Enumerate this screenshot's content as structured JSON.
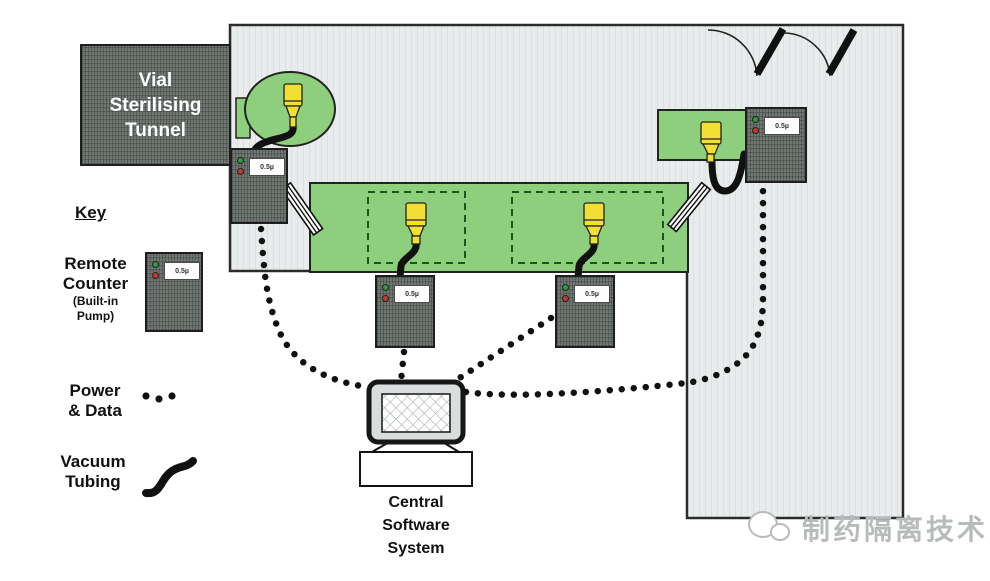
{
  "tunnel": {
    "label": "Vial\nSterilising\nTunnel"
  },
  "key": {
    "title": "Key",
    "remote_counter": {
      "label": "Remote\nCounter",
      "sublabel": "(Built-in\nPump)"
    },
    "power_data": {
      "label": "Power\n& Data"
    },
    "vacuum_tubing": {
      "label": "Vacuum\nTubing"
    }
  },
  "counters": {
    "display_text": "0.5µ"
  },
  "computer": {
    "label": "Central\nSoftware\nSystem"
  },
  "watermark": {
    "text": "制药隔离技术"
  },
  "colors": {
    "conveyor_green": "#8dcf7c",
    "equipment_gray": "#6d746f",
    "probe_yellow": "#f2df35",
    "room_gray": "#e9ecec",
    "line_black": "#111111",
    "dashed_zone_green": "#15591a",
    "watermark_gray": "#b7bbbb"
  }
}
